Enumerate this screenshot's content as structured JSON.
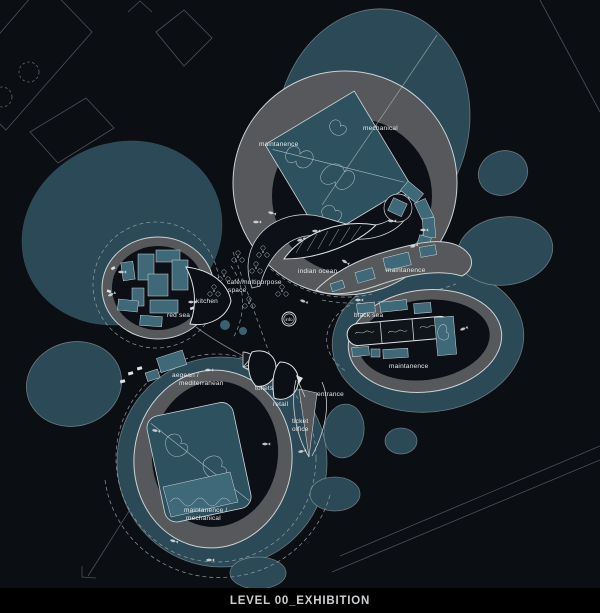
{
  "title_bar": {
    "label": "LEVEL 00_EXHIBITION"
  },
  "plan": {
    "labels": {
      "maintanence_top": "maintanence",
      "mechanical": "mechanical",
      "indian_ocean": "indian ocean",
      "maintanence_mid": "maintanence",
      "black_sea": "black sea",
      "maintanence_right": "maintanence",
      "red_sea": "red sea",
      "kitchen": "kitchen",
      "cafe_line1": "café/multiporpose",
      "cafe_line2": "space",
      "info": "info",
      "aegean_line1": "aegean /",
      "aegean_line2": "mediterranean",
      "toilets": "toilets",
      "retail": "retail",
      "ticket_line1": "ticket",
      "ticket_line2": "office",
      "entrance": "entrance",
      "maint_mech_line1": "maintanence /",
      "maint_mech_line2": "mechanical"
    },
    "colors": {
      "background": "#0b0e13",
      "water_blob_teal": "#2b4956",
      "tank_teal": "#3f6879",
      "map_teal": "#2e515f",
      "ring_gray": "#56585b",
      "pod_interior": "#0c1016",
      "line_light": "#ccd2d6",
      "text_light": "#e6e9eb",
      "title_bar_bg": "#000000"
    },
    "icons": [
      "fish-icon",
      "tree-icon",
      "info-circle-icon",
      "spiral-stair-icon",
      "entrance-arrow-icon",
      "tree-dashed-circle-icon"
    ]
  }
}
